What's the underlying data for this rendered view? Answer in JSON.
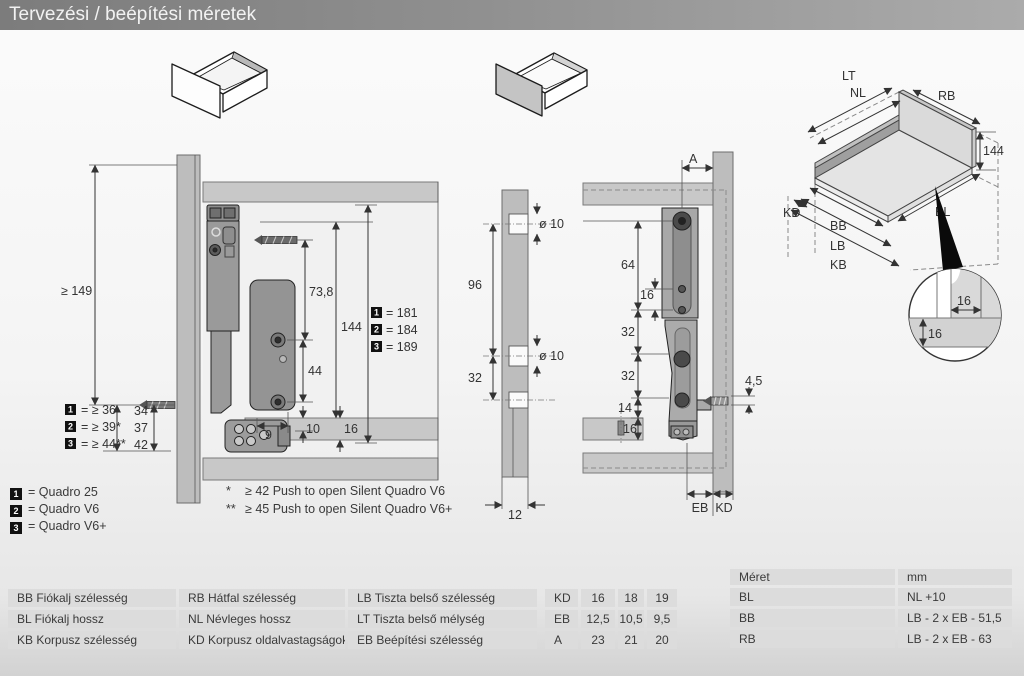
{
  "title_bar": {
    "title": "Tervezési / beépítési méretek"
  },
  "side_view": {
    "dim_min_height": "≥ 149",
    "dim_front_34": "34",
    "dim_front_37": "37",
    "dim_front_42": "42",
    "dim_73_8": "73,8",
    "dim_144": "144",
    "dim_44": "44",
    "dim_9": "9",
    "dim_10": "10",
    "dim_16": "16",
    "gap_legend": [
      {
        "num": "1",
        "label": "= ≥ 36"
      },
      {
        "num": "2",
        "label": "= ≥ 39*"
      },
      {
        "num": "3",
        "label": "= ≥ 44**"
      }
    ],
    "height_legend": [
      {
        "num": "1",
        "label": "= 181"
      },
      {
        "num": "2",
        "label": "= 184"
      },
      {
        "num": "3",
        "label": "= 189"
      }
    ]
  },
  "back_view": {
    "dim_hole_top": "ø 10",
    "dim_hole_bottom": "ø 10",
    "dim_96": "96",
    "dim_32": "32",
    "dim_12": "12"
  },
  "rear_view": {
    "dim_a": "A",
    "dim_64": "64",
    "dim_16_slot": "16",
    "dim_32_upper": "32",
    "dim_32_lower": "32",
    "dim_14": "14",
    "dim_16_bottom": "16",
    "dim_4_5": "4,5",
    "label_eb": "EB",
    "label_kd": "KD"
  },
  "iso_view": {
    "label_lt": "LT",
    "label_nl": "NL",
    "label_rb": "RB",
    "dim_144": "144",
    "label_kd": "KD",
    "label_bb": "BB",
    "label_lb": "LB",
    "label_kb": "KB",
    "label_bl": "BL",
    "detail_dim_h": "16",
    "detail_dim_v": "16"
  },
  "product_legend": [
    {
      "num": "1",
      "label": "= Quadro 25"
    },
    {
      "num": "2",
      "label": "= Quadro V6"
    },
    {
      "num": "3",
      "label": "= Quadro V6+"
    }
  ],
  "footnotes": [
    {
      "mark": "*",
      "text": "≥ 42 Push to open Silent Quadro V6"
    },
    {
      "mark": "**",
      "text": "≥ 45 Push to open Silent Quadro V6+"
    }
  ],
  "abbrev_table": {
    "rows": [
      [
        "BB Fiókalj szélesség",
        "RB Hátfal szélesség",
        "LB Tiszta belső szélesség"
      ],
      [
        "BL Fiókalj hossz",
        "NL Névleges hossz",
        "LT Tiszta belső mélység"
      ],
      [
        "KB Korpusz szélesség",
        "KD Korpusz oldalvastagságok",
        "EB Beépítési szélesség"
      ]
    ]
  },
  "values_table": {
    "rows": [
      [
        "KD",
        "16",
        "18",
        "19"
      ],
      [
        "EB",
        "12,5",
        "10,5",
        "9,5"
      ],
      [
        "A",
        "23",
        "21",
        "20"
      ]
    ]
  },
  "formula_table": {
    "header": [
      "Méret",
      "mm"
    ],
    "rows": [
      [
        "BL",
        "NL +10"
      ],
      [
        "BB",
        "LB - 2 x EB - 51,5"
      ],
      [
        "RB",
        "LB - 2 x EB - 63"
      ]
    ]
  },
  "colors": {
    "titlebar": "#8a8a8a",
    "table_cell": "#dcdcdc",
    "panel_gray": "#bdbdbd",
    "hardware_gray": "#949494"
  }
}
